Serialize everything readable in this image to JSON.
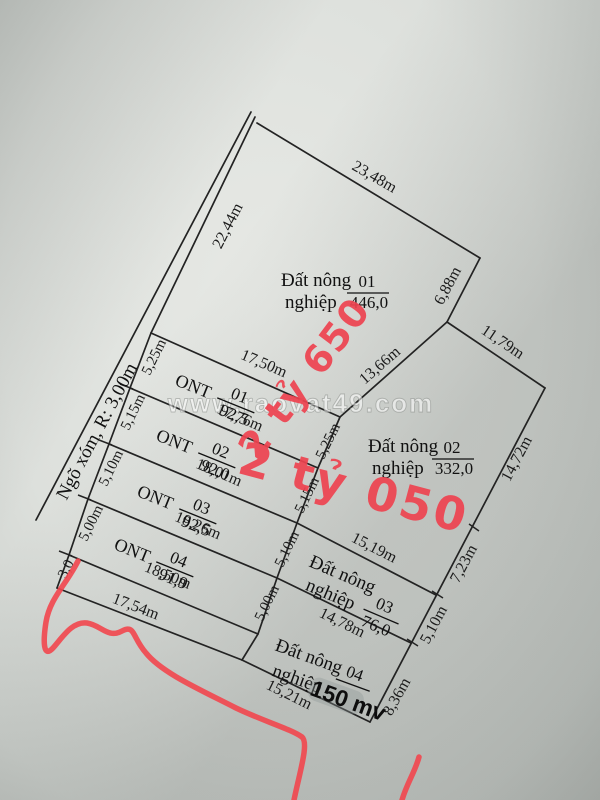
{
  "paper": {
    "watermark": "www.raovat49.com"
  },
  "road": {
    "label": "Ngõ xóm, R: 3,00m"
  },
  "prices": {
    "price_top": "2 tỷ 650",
    "price_main": "2 tỷ 050"
  },
  "plots": {
    "nn01": {
      "name1": "Đất nông",
      "name2": "nghiệp",
      "num": "01",
      "area": "446,0"
    },
    "nn02": {
      "name1": "Đất nông",
      "name2": "nghiệp",
      "num": "02",
      "area": "332,0"
    },
    "nn03": {
      "name1": "Đất nông",
      "name2": "nghiệp",
      "num": "03",
      "area": "76,0"
    },
    "nn04": {
      "name1": "Đất nông",
      "name2": "nghiệp",
      "num": "04",
      "area_note": "150 mv"
    },
    "ont01": {
      "label": "ONT",
      "num": "01",
      "area": "92,5"
    },
    "ont02": {
      "label": "ONT",
      "num": "02",
      "area": "92,0"
    },
    "ont03": {
      "label": "ONT",
      "num": "03",
      "area": "92,5"
    },
    "ont04": {
      "label": "ONT",
      "num": "04",
      "area": "91,9"
    }
  },
  "measurements": {
    "m22_44": "22,44m",
    "m23_48": "23,48m",
    "m6_88": "6,88m",
    "m13_66": "13,66m",
    "m11_79": "11,79m",
    "m14_72": "14,72m",
    "m7_23": "7,23m",
    "m5_10_r": "5,10m",
    "m8_36": "8,36m",
    "m17_50": "17,50m",
    "m17_76": "17,76m",
    "m18_01": "18,01m",
    "m18_26": "18,26m",
    "m18_50": "18,50m",
    "m17_54": "17,54m",
    "m15_19": "15,19m",
    "m14_78": "14,78m",
    "m15_21": "15,21m",
    "w_5_25_l": "5,25m",
    "w_5_15_l": "5,15m",
    "w_5_10_l": "5,10m",
    "w_5_00_l": "5,00m",
    "w_3_0": "3,0",
    "w_5_25_r": "5,25m",
    "w_5_15_r": "5,15m",
    "w_5_10_r": "5,10m",
    "w_5_00_r": "5,00m"
  },
  "colors": {
    "marker_red": "#ee4350",
    "line": "#232323"
  }
}
